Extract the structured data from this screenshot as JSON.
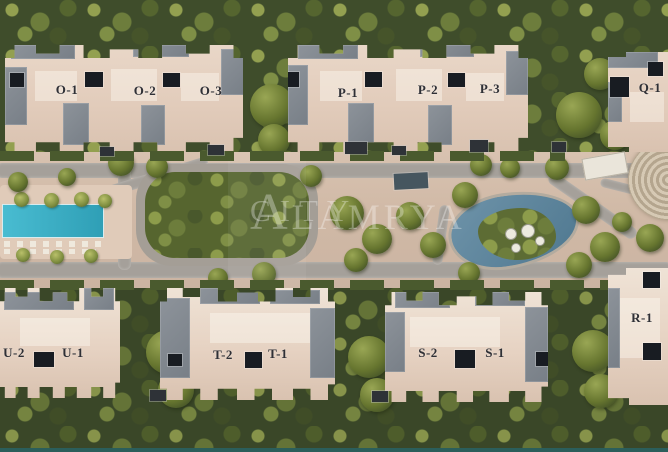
{
  "watermark": {
    "line1": "ALAMRYA",
    "line2": "CITY"
  },
  "buildings": {
    "o1": "O-1",
    "o2": "O-2",
    "o3": "O-3",
    "p1": "P-1",
    "p2": "P-2",
    "p3": "P-3",
    "q1": "Q-1",
    "u2": "U-2",
    "u1": "U-1",
    "t2": "T-2",
    "t1": "T-1",
    "s2": "S-2",
    "s1": "S-1",
    "r1": "R-1"
  },
  "colors": {
    "building_roof": "#e3d0c1",
    "building_roof_light": "#efe3d6",
    "roof_gray": "#868d94",
    "skylight_dark": "#181c22",
    "label_text": "#2f3036",
    "pool_teal": "#3fb0c4",
    "lagoon_blue": "#5f88a3",
    "foliage_dark": "#3d4a2a",
    "foliage_light": "#93a050",
    "ground_sand": "#d3bca9",
    "road_gray": "#a5a09a",
    "watermark_white": "rgba(255,255,255,0.32)",
    "bottom_edge_teal": "#2b5e5b"
  }
}
